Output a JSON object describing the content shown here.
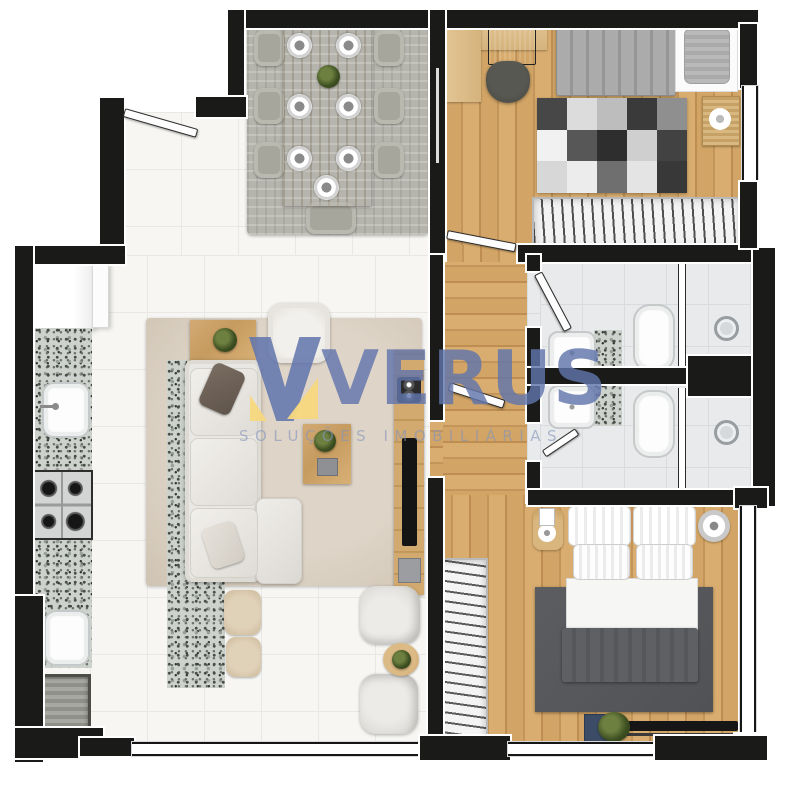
{
  "watermark": {
    "brand": "VERUS",
    "subtitle": "SOLUÇÕES IMOBILIÁRIAS"
  },
  "palette": {
    "wall": "#1a1a19",
    "wood_floor": "#cda263",
    "tile_floor": "#f7f6f3",
    "bath_tile": "#e8eaeb",
    "granite": "#cdd2cd",
    "rug_dining": "#b6b5ad",
    "rug_living": "#d8cec0",
    "rug_master": "#56585b",
    "sofa": "#e8e6e2",
    "brand_blue": "#6074ad",
    "brand_yellow": "#f7d87e",
    "subtitle_blue": "#8494bc"
  },
  "plan": {
    "type": "apartment-floor-plan-top-view",
    "rooms": [
      {
        "name": "dining-room",
        "furniture": [
          "dining-rug",
          "dining-table",
          "dining-chairs-x7",
          "place-settings-x7",
          "centerpiece-plant"
        ]
      },
      {
        "name": "living-room",
        "furniture": [
          "area-rug",
          "l-shaped-sofa",
          "throw-pillows",
          "armchair",
          "sofa-side-table",
          "coffee-table",
          "tv-console",
          "tv",
          "speaker",
          "island-counter",
          "bar-stools-x2",
          "lounge-poufs-x2",
          "round-side-table"
        ]
      },
      {
        "name": "kitchen",
        "furniture": [
          "upper-cabinet",
          "granite-countertop",
          "kitchen-sink",
          "gas-cooktop",
          "laundry-sink",
          "washing-machine"
        ]
      },
      {
        "name": "bedroom-1",
        "furniture": [
          "l-desk",
          "laptop",
          "office-chair",
          "single-bed",
          "pillow",
          "checkered-rug",
          "side-table",
          "open-wardrobe"
        ]
      },
      {
        "name": "hallway",
        "furniture": []
      },
      {
        "name": "bathroom-1",
        "furniture": [
          "vanity-sink",
          "granite-vanity",
          "toilet",
          "shower",
          "glass-partition"
        ]
      },
      {
        "name": "bathroom-2",
        "furniture": [
          "vanity-sink",
          "granite-vanity",
          "toilet",
          "shower",
          "glass-partition"
        ]
      },
      {
        "name": "bedroom-2",
        "furniture": [
          "double-bed",
          "pillows-x4",
          "dark-rug",
          "nightstand-lamp",
          "round-speaker",
          "open-wardrobe",
          "tv-shelf",
          "plant",
          "picture-frame"
        ]
      }
    ]
  }
}
